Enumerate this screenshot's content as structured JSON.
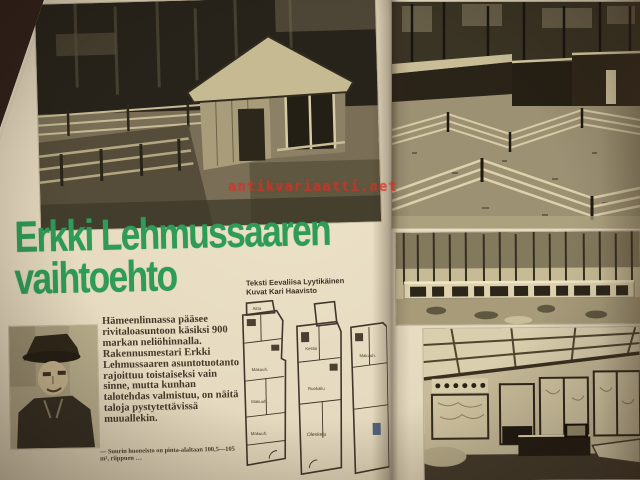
{
  "magazine": {
    "headline": {
      "line1": "Erkki Lehmussaaren",
      "line2": "vaihtoehto"
    },
    "credits": {
      "line1": "Teksti Eevaliisa Lyytikäinen",
      "line2": "Kuvat Kari Haavisto"
    },
    "intro": "Hämeenlinnassa pääsee rivitaloasuntoon käsiksi 900 markan neliöhinnalla. Rakennusmestari Erkki Lehmussaaren asuntotuotanto rajoittuu toistaiseksi vain sinne, mutta kunhan talotehdas valmistuu, on näitä taloja pystytettävissä muuallekin.",
    "caption": "— Suurin huoneisto on pinta-alaltaan 100,5—105 m², riippuen …",
    "watermark": "antikvariaatti.net",
    "floorplan": {
      "labels": {
        "a1": "Aitta",
        "a2": "Makuuh.",
        "a3": "Makuuh.",
        "a4": "Makuuh.",
        "b1": "Keittiö",
        "b2": "Ruokailu",
        "b3": "Oleskelu",
        "c1": "Makuuh."
      }
    },
    "colors": {
      "headline_green": "#2e9b57",
      "page_cream": "#e8ddc2",
      "watermark_red": "#d63026",
      "background_brown": "#31221a",
      "body_text_brown": "#46382a"
    }
  }
}
